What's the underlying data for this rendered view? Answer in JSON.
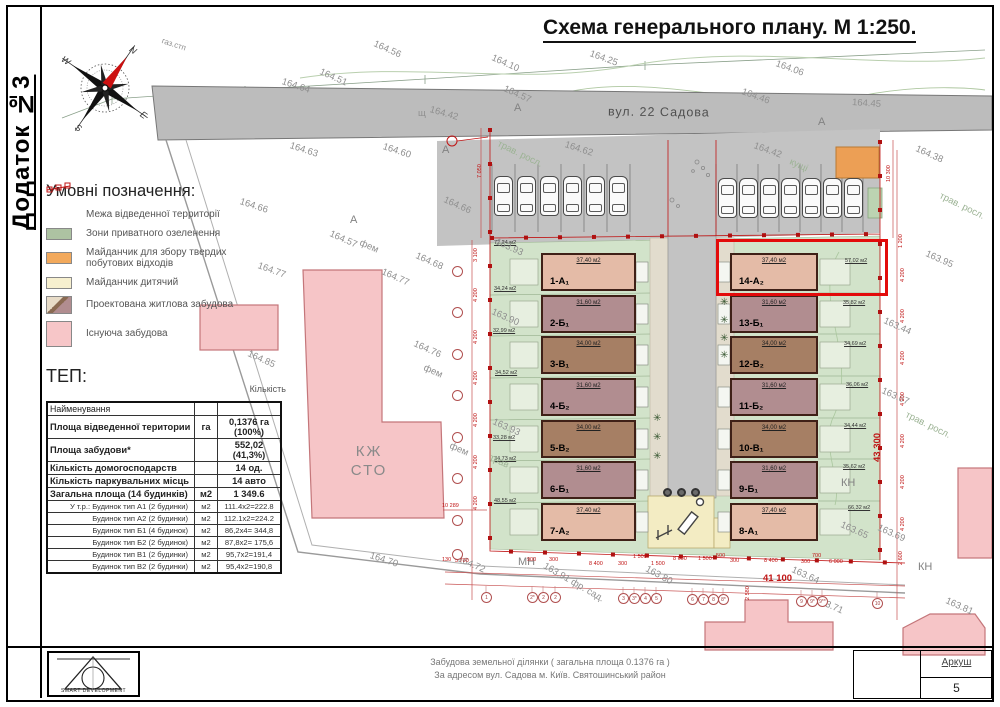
{
  "page": {
    "appendix": "Додаток №3",
    "title": "Схема генерального плану. М 1:250."
  },
  "street": {
    "name": "вул. 22 Садова"
  },
  "compass": {
    "n": "N",
    "e": "E",
    "s": "S",
    "w": "W"
  },
  "legend": {
    "title": "Умовні позначення:",
    "items": [
      {
        "label": "Межа відведенної территорії",
        "type": "boundary"
      },
      {
        "label": "Зони приватного озеленення",
        "type": "green"
      },
      {
        "label": "Майданчик для збору твердих побутових відходів",
        "type": "waste"
      },
      {
        "label": "Майданчик дитячий",
        "type": "playground"
      },
      {
        "label": "Проектована житлова забудова",
        "type": "proposed"
      },
      {
        "label": "Існуюча забудова",
        "type": "existing"
      }
    ]
  },
  "tep": {
    "title": "ТЕП:",
    "name_header": "Найменування",
    "qty_header": "Кількість",
    "rows": [
      {
        "name": "Площа відведенної територии",
        "unit": "га",
        "value": "0,1376 га (100%)"
      },
      {
        "name": "Площа забудови*",
        "unit": "",
        "value": "552,02 (41,3%)"
      },
      {
        "name": "Кількість домогосподарств",
        "unit": "",
        "value": "14 од."
      },
      {
        "name": "Кількість паркувальних місць",
        "unit": "",
        "value": "14 авто"
      },
      {
        "name": "Загальна площа (14 будинків)",
        "unit": "м2",
        "value": "1 349.6"
      },
      {
        "name": "У т.р.: Будинок тип А1 (2 будинки)",
        "unit": "м2",
        "value": "111.4х2=222.8"
      },
      {
        "name": "Будинок тип А2 (2 будинки)",
        "unit": "м2",
        "value": "112.1х2=224.2"
      },
      {
        "name": "Будинок тип Б1 (4 будинок)",
        "unit": "м2",
        "value": "86,2х4= 344,8"
      },
      {
        "name": "Будинок тип Б2 (2 будинок)",
        "unit": "м2",
        "value": "87,8х2= 175,6"
      },
      {
        "name": "Будинок тип В1 (2 будинки)",
        "unit": "м2",
        "value": "95,7х2=191,4"
      },
      {
        "name": "Будинок тип В2 (2 будинки)",
        "unit": "м2",
        "value": "95,4х2=190,8"
      }
    ]
  },
  "buildings": {
    "left": [
      {
        "id": "1-А₁",
        "area": "37,40 м2"
      },
      {
        "id": "2-Б₁",
        "area": "31,60 м2"
      },
      {
        "id": "3-В₁",
        "area": "34,00 м2"
      },
      {
        "id": "4-Б₂",
        "area": "31,60 м2"
      },
      {
        "id": "5-В₂",
        "area": "34,00 м2"
      },
      {
        "id": "6-Б₁",
        "area": "31,60 м2"
      },
      {
        "id": "7-А₂",
        "area": "37,40 м2"
      }
    ],
    "right": [
      {
        "id": "14-А₂",
        "area": "37,40 м2"
      },
      {
        "id": "13-Б₁",
        "area": "31,60 м2"
      },
      {
        "id": "12-В₂",
        "area": "34,00 м2"
      },
      {
        "id": "11-Б₂",
        "area": "31,60 м2"
      },
      {
        "id": "10-В₁",
        "area": "34,00 м2"
      },
      {
        "id": "9-Б₁",
        "area": "31,60 м2"
      },
      {
        "id": "8-А₁",
        "area": "37,40 м2"
      }
    ]
  },
  "gardens": {
    "left": [
      "72,24 м2",
      "34,24 м2",
      "32,99 м2",
      "34,52 м2",
      "33,28 м2",
      "34,73 м2",
      "48,55 м2"
    ],
    "right": [
      "57,02 м2",
      "35,82 м2",
      "34,69 м2",
      "36,06 м2",
      "34,44 м2",
      "35,62 м2",
      "66,32 м2"
    ]
  },
  "existing": {
    "garage_line1": "КЖ",
    "garage_line2": "СТО"
  },
  "dims": {
    "left": [
      "7 050",
      "3 100",
      "4 200",
      "4 200",
      "4 200",
      "4 200",
      "4 200",
      "4 200"
    ],
    "right": [
      "10 300",
      "1 200",
      "4 200",
      "4 200",
      "4 200",
      "4 200",
      "4 200",
      "4 200",
      "4 200",
      "2 600"
    ],
    "right_total": "43 300",
    "bottom": [
      "130",
      "5 700",
      "900",
      "300",
      "8 400",
      "300",
      "1 500",
      "1 500",
      "8 600",
      "1 500",
      "500",
      "300",
      "8 400",
      "300",
      "700",
      "6 000"
    ],
    "bottom_total": "41 100"
  },
  "axes": {
    "bottom": [
      "1",
      "2*",
      "2",
      "2",
      "3",
      "3*",
      "4",
      "5",
      "6",
      "7",
      "8",
      "8*",
      "9",
      "9*",
      "9**",
      "10"
    ]
  },
  "annotations": [
    "газ.стп",
    "164.64",
    "164.56",
    "164.51",
    "164.25",
    "164.06",
    "164.46",
    "164.45",
    "164.10",
    "164.57",
    "щ",
    "164.42",
    "164.63",
    "164.60",
    "164.62",
    "164.42",
    "кущі",
    "164.38",
    "трав. росл.",
    "163.95",
    "трав. росл.",
    "164.66",
    "164.66",
    "164.57",
    "фем",
    "164.77",
    "164.77",
    "164.68",
    "164.76",
    "фем",
    "фем",
    "163.93",
    "163.90",
    "163.93",
    "трав",
    "164.85",
    "164.70",
    "164.72",
    "МН",
    "163.91 фр. сад.",
    "163.80",
    "163.64",
    "163.71",
    "КН",
    "КН",
    "163.44",
    "163.67",
    "трав. росл.",
    "163.65",
    "163.69",
    "163.81",
    "10 289",
    "2 580",
    "А",
    "А",
    "А",
    "А"
  ],
  "colors": {
    "type_a": "#e4bba7",
    "type_b": "#b18d90",
    "type_v": "#a67f64",
    "existing_pink": "#f6c5c7",
    "site_green": "#d2e3ca",
    "road_gray": "#bcbcbc",
    "playground_yellow": "#f3ecc3",
    "waste_orange": "#ec9f55",
    "boundary_red": "#c01414"
  },
  "footer": {
    "company": "SMART DEVELOPMENT",
    "line1": "Забудова земельної ділянки ( загальна площа 0.1376 га )",
    "line2": "За адресом вул. Садова  м. Київ. Святошинський район",
    "sheet_label": "Аркуш",
    "sheet_number": "5"
  }
}
